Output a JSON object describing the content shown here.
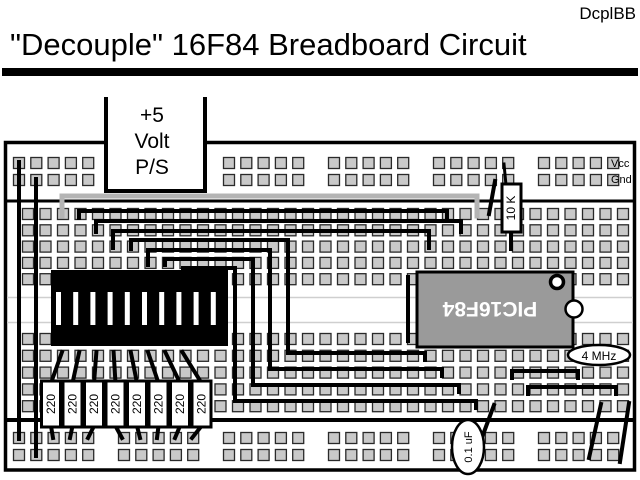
{
  "header": {
    "code": "DcplBB",
    "title": "\"Decouple\" 16F84 Breadboard Circuit"
  },
  "power_supply": {
    "lines": [
      "+5",
      "Volt",
      "P/S"
    ]
  },
  "rail_labels": {
    "vcc": "Vcc",
    "gnd": "Gnd"
  },
  "components": {
    "pullup_resistor_label": "10 K",
    "series_resistor_label": "220",
    "mcu_label": "PIC16F84",
    "resonator_label": "4 MHz",
    "capacitor_label": "0.1 uF",
    "dip_switch_positions": 10
  },
  "colors": {
    "wire": "#000000",
    "power_wire": "#b4b4b4",
    "chip_fill": "#9a9a9a",
    "hole_fill": "#c9c9c9",
    "hole_border": "#2a2a2a",
    "board_border": "#000000"
  }
}
